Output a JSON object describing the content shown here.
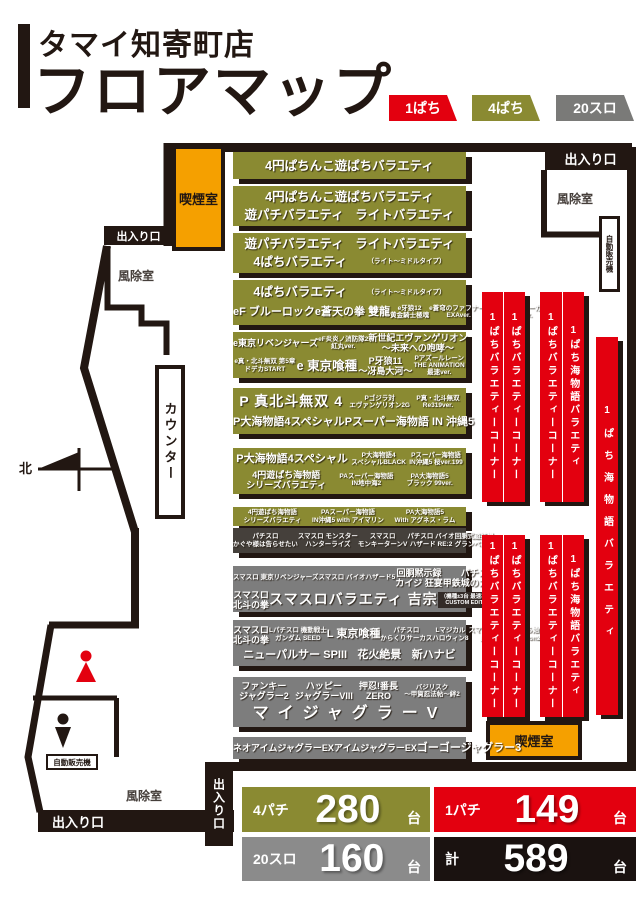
{
  "header": {
    "store_name": "タマイ知寄町店",
    "page_title": "フロアマップ",
    "legend": [
      {
        "label": "1ぱち",
        "color": "#e3000f"
      },
      {
        "label": "4ぱち",
        "color": "#8a8a32"
      },
      {
        "label": "20スロ",
        "color": "#7a7a78"
      }
    ]
  },
  "rooms": {
    "smoking": "喫煙室",
    "entrance": "出入り口",
    "windbreak": "風除室",
    "vending": "自動販売機",
    "counter": "カウンター",
    "north": "北"
  },
  "red_banners": [
    {
      "cols": [
        "1ぱちバラエティーコーナー",
        "1ぱちバラエティーコーナー"
      ]
    },
    {
      "cols": [
        "1ぱちバラエティーコーナー",
        "1ぱち海物語バラエティ"
      ]
    },
    {
      "cols": [
        "1ぱちバラエティーコーナー",
        "1ぱちバラエティーコーナー"
      ]
    },
    {
      "cols": [
        "1ぱちバラエティーコーナー",
        "1ぱち海物語バラエティ"
      ]
    },
    {
      "cols": [
        "1ぱち海物語バラエティ"
      ]
    }
  ],
  "bands": [
    {
      "type": "p4",
      "rows": [
        {
          "items": [
            {
              "t": "4円ぱちんこ遊ぱちバラエティ",
              "s": "lg"
            }
          ]
        }
      ]
    },
    {
      "type": "p4",
      "rows": [
        {
          "items": [
            {
              "t": "4円ぱちんこ遊ぱちバラエティ",
              "s": "lg"
            }
          ]
        },
        {
          "items": [
            {
              "t": "遊パチバラエティ",
              "s": "lg"
            },
            {
              "t": "ライトバラエティ",
              "s": "lg"
            }
          ]
        }
      ]
    },
    {
      "type": "p4",
      "rows": [
        {
          "items": [
            {
              "t": "遊パチバラエティ",
              "s": "lg"
            },
            {
              "t": "ライトバラエティ",
              "s": "lg"
            }
          ]
        },
        {
          "items": [
            {
              "t": "4ぱちバラエティ",
              "s": "lg"
            },
            {
              "t": "（ライト～ミドルタイプ）",
              "s": "xs"
            }
          ]
        }
      ]
    },
    {
      "type": "p4",
      "rows": [
        {
          "items": [
            {
              "t": "4ぱちバラエティ",
              "s": "lg"
            },
            {
              "t": "（ライト～ミドルタイプ）",
              "s": "xs"
            }
          ]
        },
        {
          "items": [
            {
              "t": "eF ブルーロック",
              "s": "md"
            },
            {
              "t": "e蒼天の拳 雙龍",
              "s": "md"
            },
            {
              "t": "e牙狼12\n黄金騎士極魂",
              "s": "xs"
            },
            {
              "t": "e蒼穹のファフナー3\nEXAver.",
              "s": "xs"
            },
            {
              "t": "eFからくりサーカス2\n魔王ver.",
              "s": "xs"
            }
          ]
        }
      ]
    },
    {
      "type": "p4",
      "rows": [
        {
          "items": [
            {
              "t": "e東京リベンジャーズ",
              "s": "sm"
            },
            {
              "t": "eF炎炎ノ消防隊2\n紅丸ver.",
              "s": "xs"
            },
            {
              "t": "新世紀エヴァンゲリオン\n～未来への咆哮～",
              "s": "sm"
            }
          ]
        },
        {
          "items": [
            {
              "t": "e真・北斗無双 第5章\nドデカSTART",
              "s": "xs"
            },
            {
              "t": "e 東京喰種",
              "s": "lg"
            },
            {
              "t": "P牙狼11\n～冴島大河～",
              "s": "sm"
            },
            {
              "t": "Pアズールレーン\nTHE ANIMATION\n最速ver.",
              "s": "xs"
            }
          ]
        }
      ]
    },
    {
      "type": "p4",
      "rows": [
        {
          "items": [
            {
              "t": "P 真北斗無双 4",
              "s": "xl"
            },
            {
              "t": "Pゴジラ対\nエヴァンゲリオン2G",
              "s": "xs"
            },
            {
              "t": "P真・北斗無双\nRe319ver.",
              "s": "xs"
            }
          ]
        },
        {
          "items": [
            {
              "t": "P大海物語4スペシャル",
              "s": "md"
            },
            {
              "t": "Pスーパー海物語 IN 沖縄5",
              "s": "md"
            }
          ]
        }
      ]
    },
    {
      "type": "p4",
      "rows": [
        {
          "items": [
            {
              "t": "P大海物語4スペシャル",
              "s": "md"
            },
            {
              "t": "P大海物語4\nスペシャルBLACK",
              "s": "xs"
            },
            {
              "t": "Pスーパー海物語\nIN沖縄5 桜ver.199",
              "s": "xs"
            }
          ]
        },
        {
          "items": [
            {
              "t": "4円遊ぱち海物語\nシリーズバラエティ",
              "s": "sm"
            },
            {
              "t": "PAスーパー海物語\nIN地中海2",
              "s": "xs"
            },
            {
              "t": "PA大海物語5\nブラック 99ver.",
              "s": "xs"
            }
          ]
        }
      ]
    },
    {
      "type": "p4",
      "rows": [
        {
          "items": [
            {
              "t": "4円遊ぱち海物語\nシリーズバラエティ",
              "s": "xs"
            },
            {
              "t": "PAスーパー海物語\nIN沖縄5 with アイマリン",
              "s": "xs"
            },
            {
              "t": "PA大海物語5\nWith アグネス・ラム",
              "s": "xs"
            }
          ]
        }
      ]
    },
    {
      "type": "slodark",
      "rows": [
        {
          "items": [
            {
              "t": "パチスロ\nかぐや様は告らせたい",
              "s": "xs"
            },
            {
              "t": "スマスロ モンスター\nハンターライズ",
              "s": "xs"
            },
            {
              "t": "スマスロ\nモンキーターンV",
              "s": "xs"
            },
            {
              "t": "パチスロ バイオ\nハザード RE:2",
              "s": "xs"
            },
            {
              "t": "回胴式遊技機\nグランベルム",
              "s": "xs"
            }
          ]
        }
      ]
    },
    {
      "type": "slo",
      "rows": [
        {
          "items": [
            {
              "t": "スマスロ 東京リベンジャーズ",
              "s": "xs"
            },
            {
              "t": "スマスロ バイオハザード5",
              "s": "xs"
            },
            {
              "t": "回胴黙示録\nカイジ 狂宴",
              "s": "sm"
            },
            {
              "t": "パチスロ\n甲鉄城のカバネリ",
              "s": "sm"
            }
          ]
        },
        {
          "items": [
            {
              "t": "スマスロ\n北斗の拳",
              "s": "sm"
            },
            {
              "t": "スマスロバラエティ 吉宗",
              "s": "xl"
            },
            {
              "t": "（機種±3台 最速導入）\nCUSTOM EDITION",
              "s": "badge"
            }
          ]
        }
      ]
    },
    {
      "type": "slo",
      "rows": [
        {
          "items": [
            {
              "t": "スマスロ\n北斗の拳",
              "s": "sm"
            },
            {
              "t": "Lパチスロ 機動戦士\nガンダム SEED",
              "s": "xs"
            },
            {
              "t": "L 東京喰種",
              "s": "md"
            },
            {
              "t": "パチスロ\nからくりサーカス",
              "s": "xs"
            },
            {
              "t": "Lマジカル\nハロウィン8",
              "s": "xs"
            },
            {
              "t": "スマスロ Re:ゼロから始まる\n異世界生活 season2",
              "s": "xs"
            }
          ]
        },
        {
          "items": [
            {
              "t": "ニューパルサー SPIII",
              "s": "md"
            },
            {
              "t": "花火絶景",
              "s": "md"
            },
            {
              "t": "新ハナビ",
              "s": "md"
            }
          ]
        }
      ]
    },
    {
      "type": "slo",
      "rows": [
        {
          "items": [
            {
              "t": "ファンキー\nジャグラー2",
              "s": "sm"
            },
            {
              "t": "ハッピー\nジャグラーVIII",
              "s": "sm"
            },
            {
              "t": "押忍!番長\nZERO",
              "s": "sm"
            },
            {
              "t": "バジリスク\n～甲賀忍法帖～絆2",
              "s": "xs"
            }
          ]
        },
        {
          "items": [
            {
              "t": "マイジャグラーV",
              "s": "xxl"
            }
          ]
        }
      ]
    },
    {
      "type": "slo",
      "rows": [
        {
          "items": [
            {
              "t": "ネオアイムジャグラーEX",
              "s": "sm"
            },
            {
              "t": "アイムジャグラーEX",
              "s": "sm"
            },
            {
              "t": "ゴーゴージャグラー3",
              "s": "md"
            }
          ]
        }
      ]
    }
  ],
  "summary": {
    "cells": [
      {
        "label": "4パチ",
        "value": "280",
        "unit": "台"
      },
      {
        "label": "1パチ",
        "value": "149",
        "unit": "台"
      },
      {
        "label": "20スロ",
        "value": "160",
        "unit": "台"
      },
      {
        "label": "計",
        "value": "589",
        "unit": "台"
      }
    ]
  },
  "colors": {
    "red": "#e3000f",
    "olive": "#8a8a32",
    "gray": "#7d7d7d",
    "charcoal": "#45403b",
    "orange": "#f5a000",
    "wall": "#221712"
  }
}
